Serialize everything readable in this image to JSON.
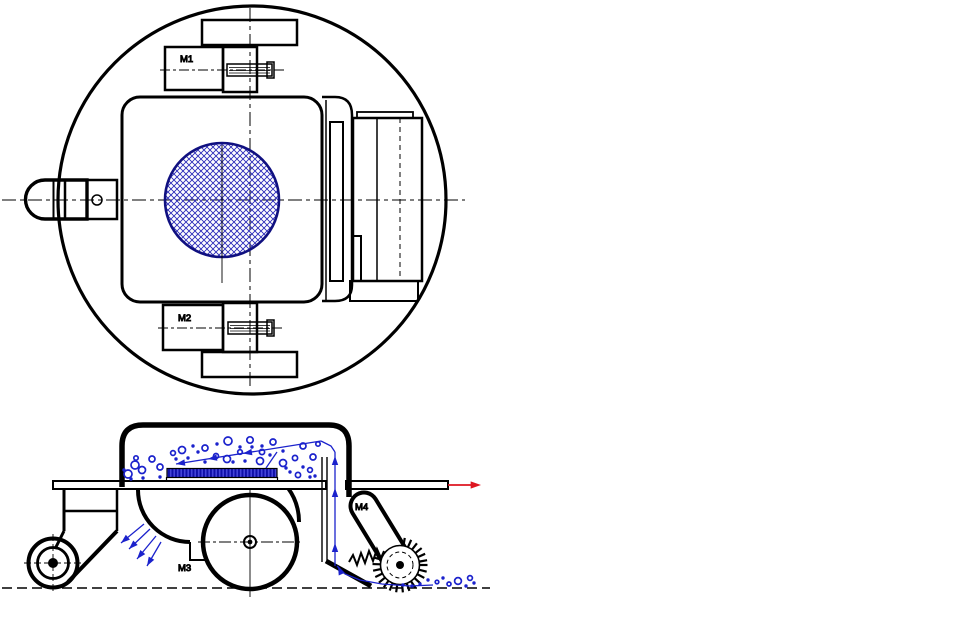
{
  "drawing": {
    "type": "engineering-drawing-cleaning-robot",
    "labels": {
      "m1": "M1",
      "m2": "M2",
      "m3": "M3",
      "m4": "M4"
    },
    "colors": {
      "ink": "#000000",
      "debris": "#1B22CC",
      "hatch_circle": "#2A2AB8",
      "hatch_outline": "#101080",
      "tray_dark": "#0F0FA8",
      "tray_light": "#4343D8",
      "arrow_red": "#DE1620",
      "background": "#FFFFFF"
    },
    "debris": {
      "bin_rings": [
        [
          135,
          465,
          4
        ],
        [
          128,
          474,
          4
        ],
        [
          142,
          470,
          3.5
        ],
        [
          152,
          459,
          3
        ],
        [
          160,
          467,
          3
        ],
        [
          182,
          450,
          3.5
        ],
        [
          205,
          448,
          3
        ],
        [
          216,
          456,
          2.5
        ],
        [
          228,
          441,
          4
        ],
        [
          250,
          440,
          3.2
        ],
        [
          262,
          452,
          2.6
        ],
        [
          273,
          442,
          3
        ],
        [
          227,
          459,
          3.5
        ],
        [
          240,
          452,
          2.3
        ],
        [
          260,
          461,
          3.5
        ],
        [
          283,
          463,
          3.5
        ],
        [
          295,
          458,
          2.6
        ],
        [
          313,
          457,
          3
        ],
        [
          298,
          475,
          2.6
        ],
        [
          310,
          470,
          2.4
        ],
        [
          173,
          453,
          2.4
        ],
        [
          303,
          446,
          3
        ],
        [
          318,
          444,
          2.2
        ],
        [
          136,
          458,
          2.2
        ]
      ],
      "bin_dots": [
        [
          131,
          479
        ],
        [
          143,
          478
        ],
        [
          160,
          477
        ],
        [
          193,
          446
        ],
        [
          217,
          444
        ],
        [
          240,
          447
        ],
        [
          262,
          446
        ],
        [
          283,
          451
        ],
        [
          290,
          472
        ],
        [
          303,
          467
        ],
        [
          310,
          477
        ],
        [
          315,
          476
        ],
        [
          205,
          462
        ],
        [
          188,
          458
        ],
        [
          252,
          447
        ],
        [
          270,
          455
        ],
        [
          286,
          468
        ],
        [
          124,
          470
        ],
        [
          233,
          462
        ],
        [
          245,
          461
        ],
        [
          198,
          452
        ],
        [
          176,
          459
        ]
      ],
      "ground_rings": [
        [
          458,
          581,
          3.4
        ],
        [
          470,
          578,
          2.4
        ],
        [
          449,
          584,
          2
        ],
        [
          437,
          582,
          1.8
        ]
      ],
      "ground_dots": [
        [
          420,
          584
        ],
        [
          428,
          580
        ],
        [
          443,
          578
        ],
        [
          466,
          586
        ],
        [
          474,
          583
        ],
        [
          412,
          586
        ],
        [
          403,
          585
        ]
      ]
    },
    "brush": {
      "cx": 400,
      "cy": 565,
      "r_core": 19.5,
      "r_teeth": 27.5,
      "teeth_step_deg": 14,
      "teeth_gap_from_deg": 205,
      "teeth_gap_to_deg": 275
    }
  }
}
